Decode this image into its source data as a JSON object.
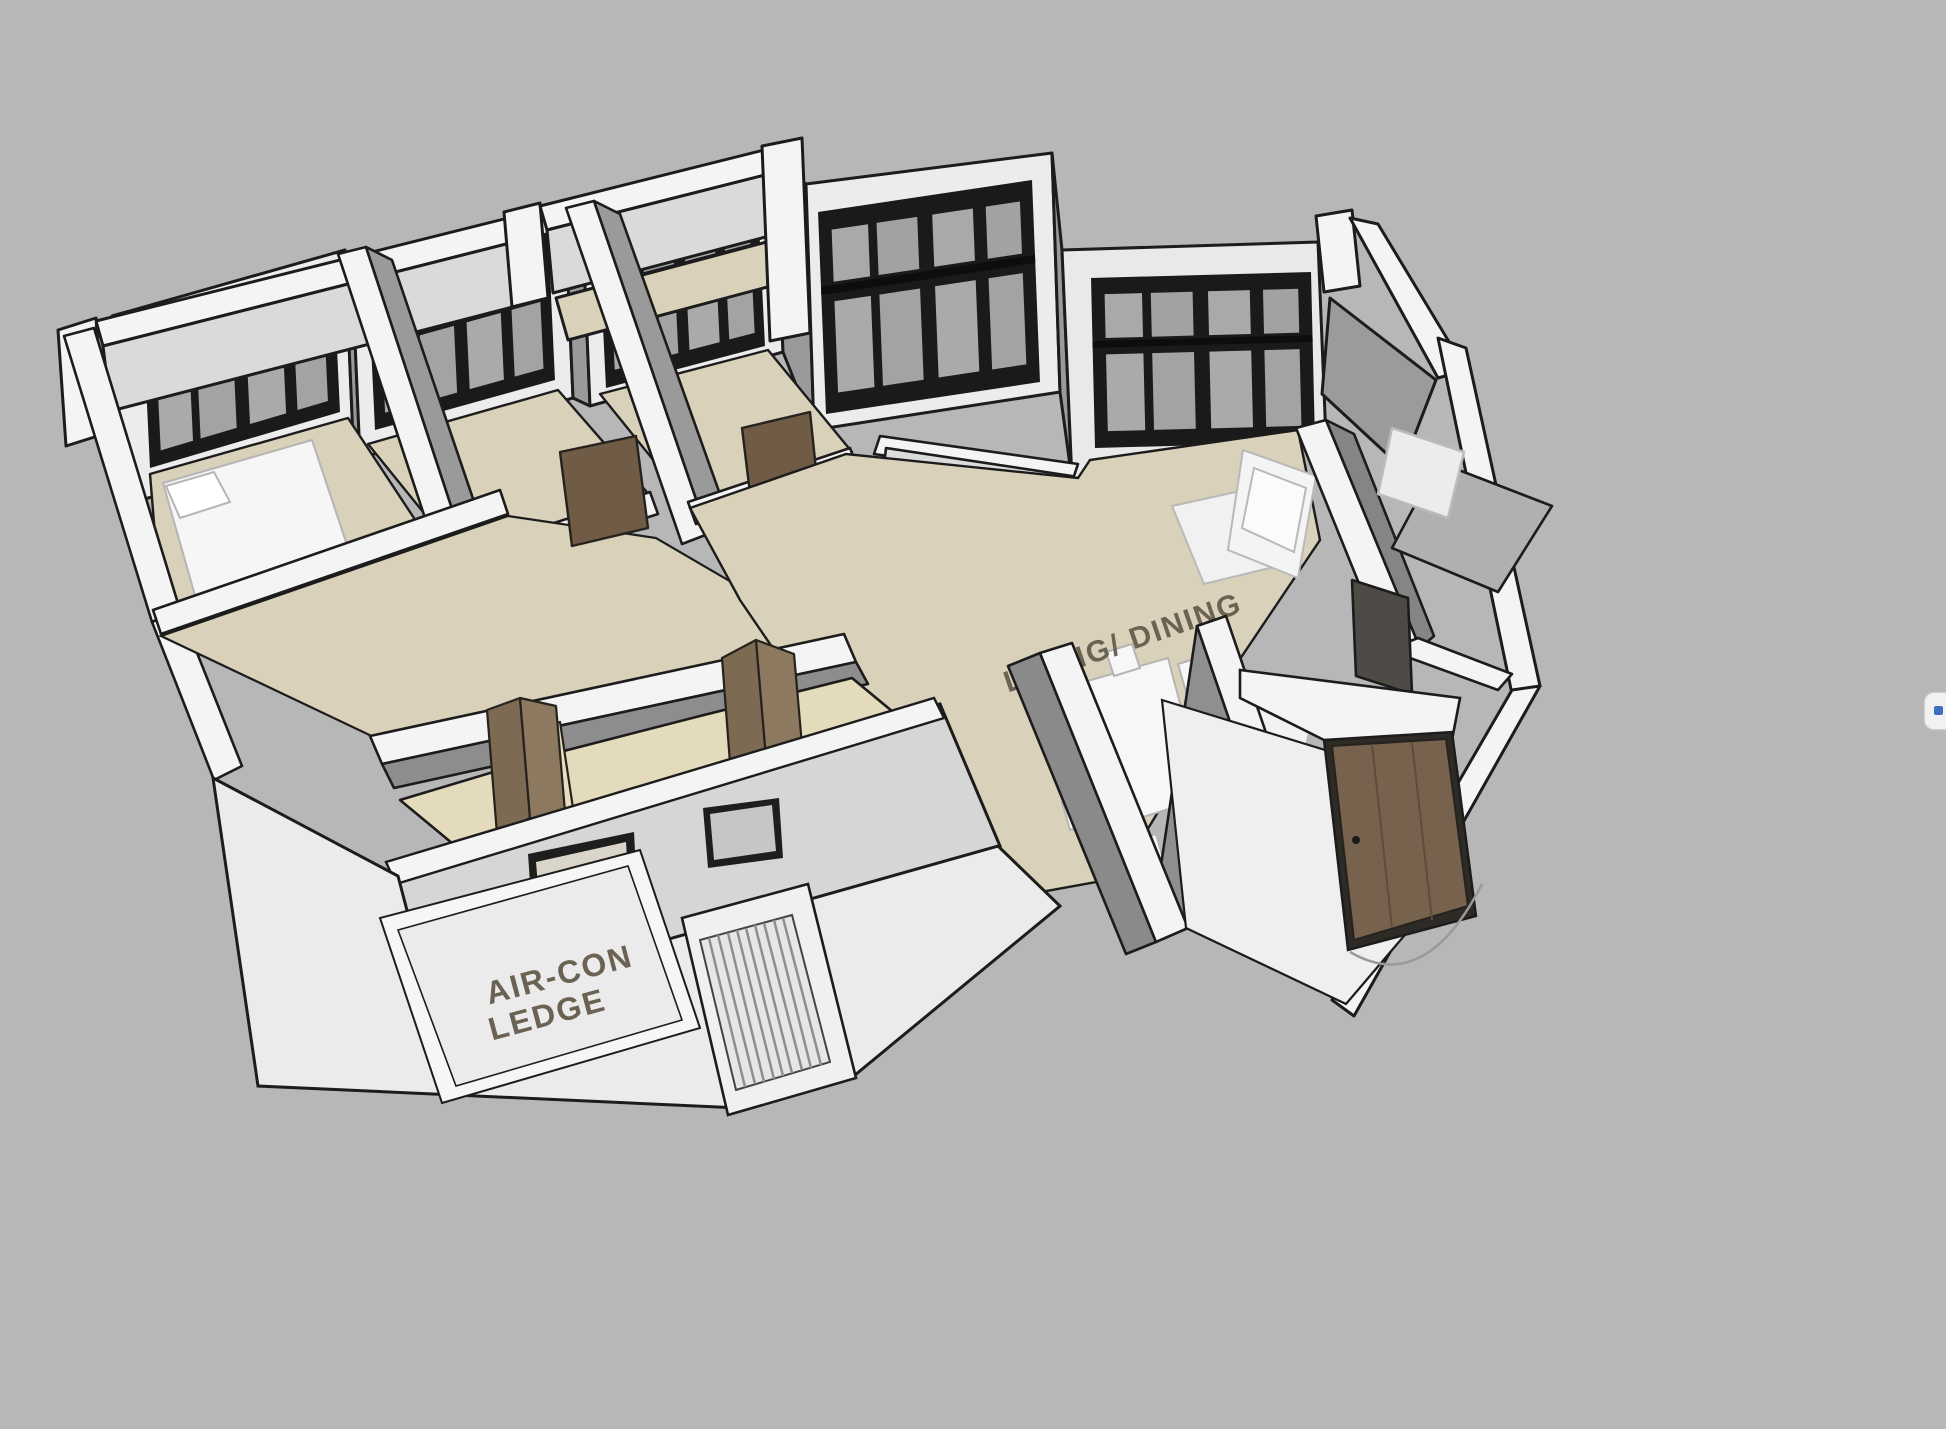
{
  "labels": {
    "living_dining": "LIVING/ DINING",
    "aircon_line1": "AIR-CON",
    "aircon_line2": "LEDGE",
    "bath_line1": "BATH/",
    "bath_line2": "WC"
  },
  "colors": {
    "background": "#b7b7b7",
    "wall_white": "#f4f4f4",
    "wall_light": "#dcdcdc",
    "wall_gray": "#9a9a9a",
    "wall_dark": "#7d7d7d",
    "floor_beige": "#d9d1b9",
    "floor_cream": "#e6dcc1",
    "floor_white": "#efefef",
    "floor_gray": "#b0b0b0",
    "window_frame": "#1a1a1a",
    "glass": "#a9a9a9",
    "door_wood": "#77624e",
    "door_wood_light": "#8d795f",
    "outline": "#1c1c1c",
    "label_text": "#6b6254",
    "accent_blue": "#3f6dbf"
  },
  "scene": {
    "floor_labels": [
      "LIVING/ DINING",
      "AIR-CON LEDGE",
      "BATH/ WC"
    ],
    "elements": [
      "bedroom-window",
      "living-window",
      "entrance-door",
      "bifold-door",
      "dining-table",
      "dining-chair",
      "bed",
      "sofa",
      "rug",
      "louver-vent",
      "door-swing-arc",
      "aircon-ledge-frame"
    ]
  },
  "ui": {
    "side_tab_icon": "blue-handle-glyph"
  }
}
